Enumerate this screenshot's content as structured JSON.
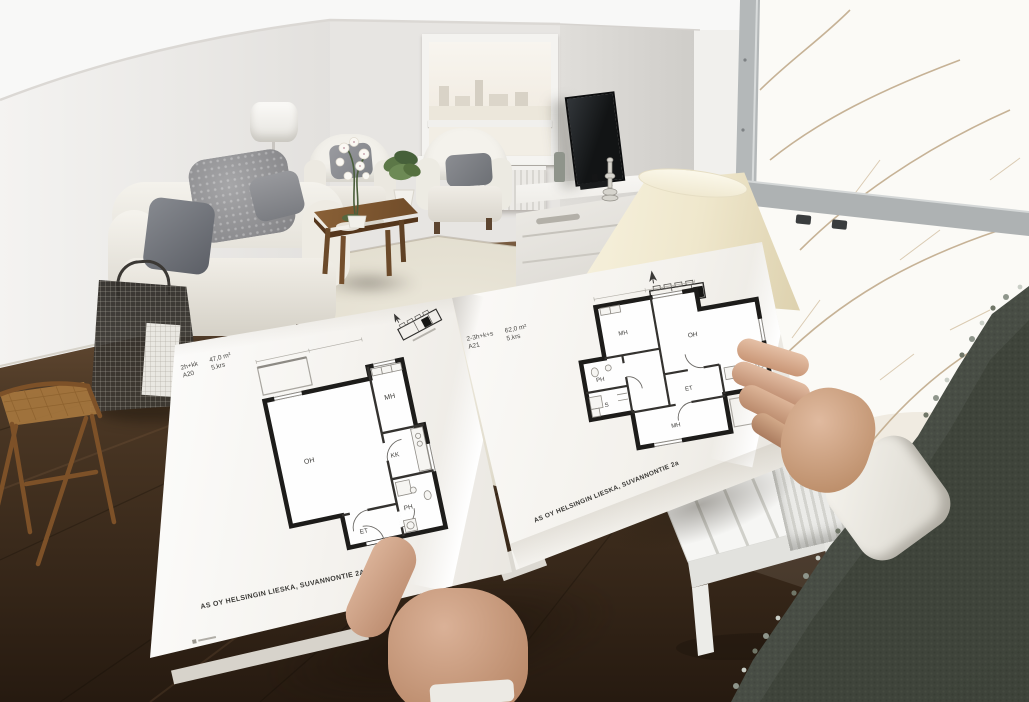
{
  "scene": {
    "description": "Wide-angle photo: a person holds an open apartment floor-plan brochure in a bright staged living room with winter window views",
    "setting_items": [
      "white sofa with gray pillows",
      "two white armchairs",
      "wooden coffee table with white orchid",
      "white shag rug",
      "dark wood floor",
      "flat-screen TV on white sideboard",
      "cream lamp shade",
      "wire magazine basket",
      "white slatted bench",
      "radiator",
      "snowy trees outside windows"
    ]
  },
  "palette": {
    "wall": "#ebe9e6",
    "floor_wood": "#4a3627",
    "rug": "#e4dfd2",
    "page": "#fbfaf8",
    "sweater": "#3f443b",
    "plan_wall": "#1d1c1a"
  },
  "brochure": {
    "left_page": {
      "header": {
        "unit_type": "2h+kk",
        "unit_id": "A20",
        "area": "47,0 m²",
        "floor": "5.krs"
      },
      "rooms": {
        "living": "OH",
        "bedroom": "MH",
        "kitchenette": "KK",
        "bathroom": "PH",
        "hallway": "ET"
      },
      "footer": "AS OY HELSINGIN LIESKA, SUVANNONTIE 2A"
    },
    "right_page": {
      "header": {
        "unit_type": "2-3h+k+s",
        "unit_id": "A21",
        "area": "62,0 m²",
        "floor": "5.krs"
      },
      "rooms": {
        "living": "OH",
        "bedroom_1": "MH",
        "bedroom_2": "MH",
        "kitchen": "K",
        "bathroom": "PH",
        "sauna": "S",
        "hallway": "ET"
      },
      "footer": "AS OY HELSINGIN LIESKA, SUVANNONTIE 2a"
    }
  }
}
